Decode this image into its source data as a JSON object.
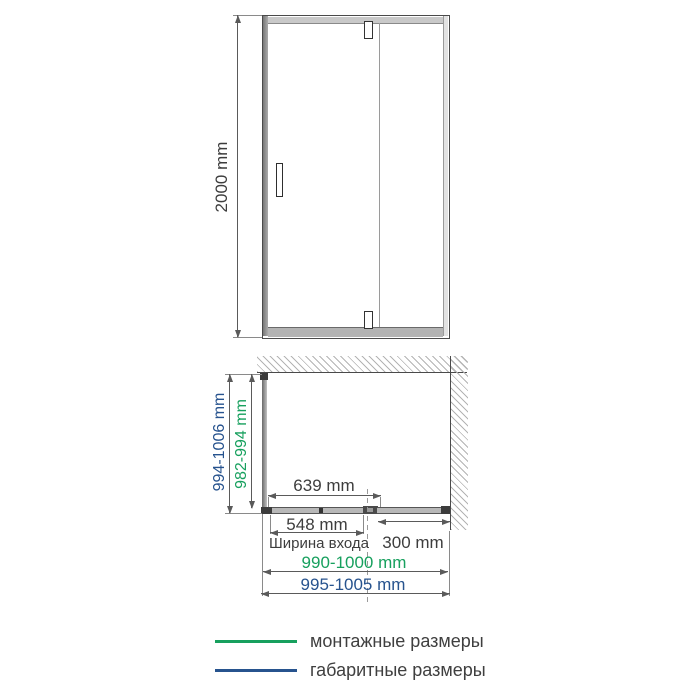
{
  "colors": {
    "mounting_green": "#17A05E",
    "overall_blue": "#27538E",
    "dim_line_gray": "#5a5a5a",
    "text_dark": "#3d3d3d"
  },
  "front_view": {
    "height_dim": "2000 mm"
  },
  "plan_view": {
    "depth_overall": "994-1006 mm",
    "depth_mounting": "982-994 mm",
    "door_glass_width": "639 mm",
    "entrance_width_value": "548 mm",
    "entrance_width_label": "Ширина входа",
    "fixed_panel_width": "300 mm",
    "width_mounting": "990-1000 mm",
    "width_overall": "995-1005 mm"
  },
  "legend": {
    "mounting_label": "монтажные размеры",
    "overall_label": "габаритные размеры"
  }
}
